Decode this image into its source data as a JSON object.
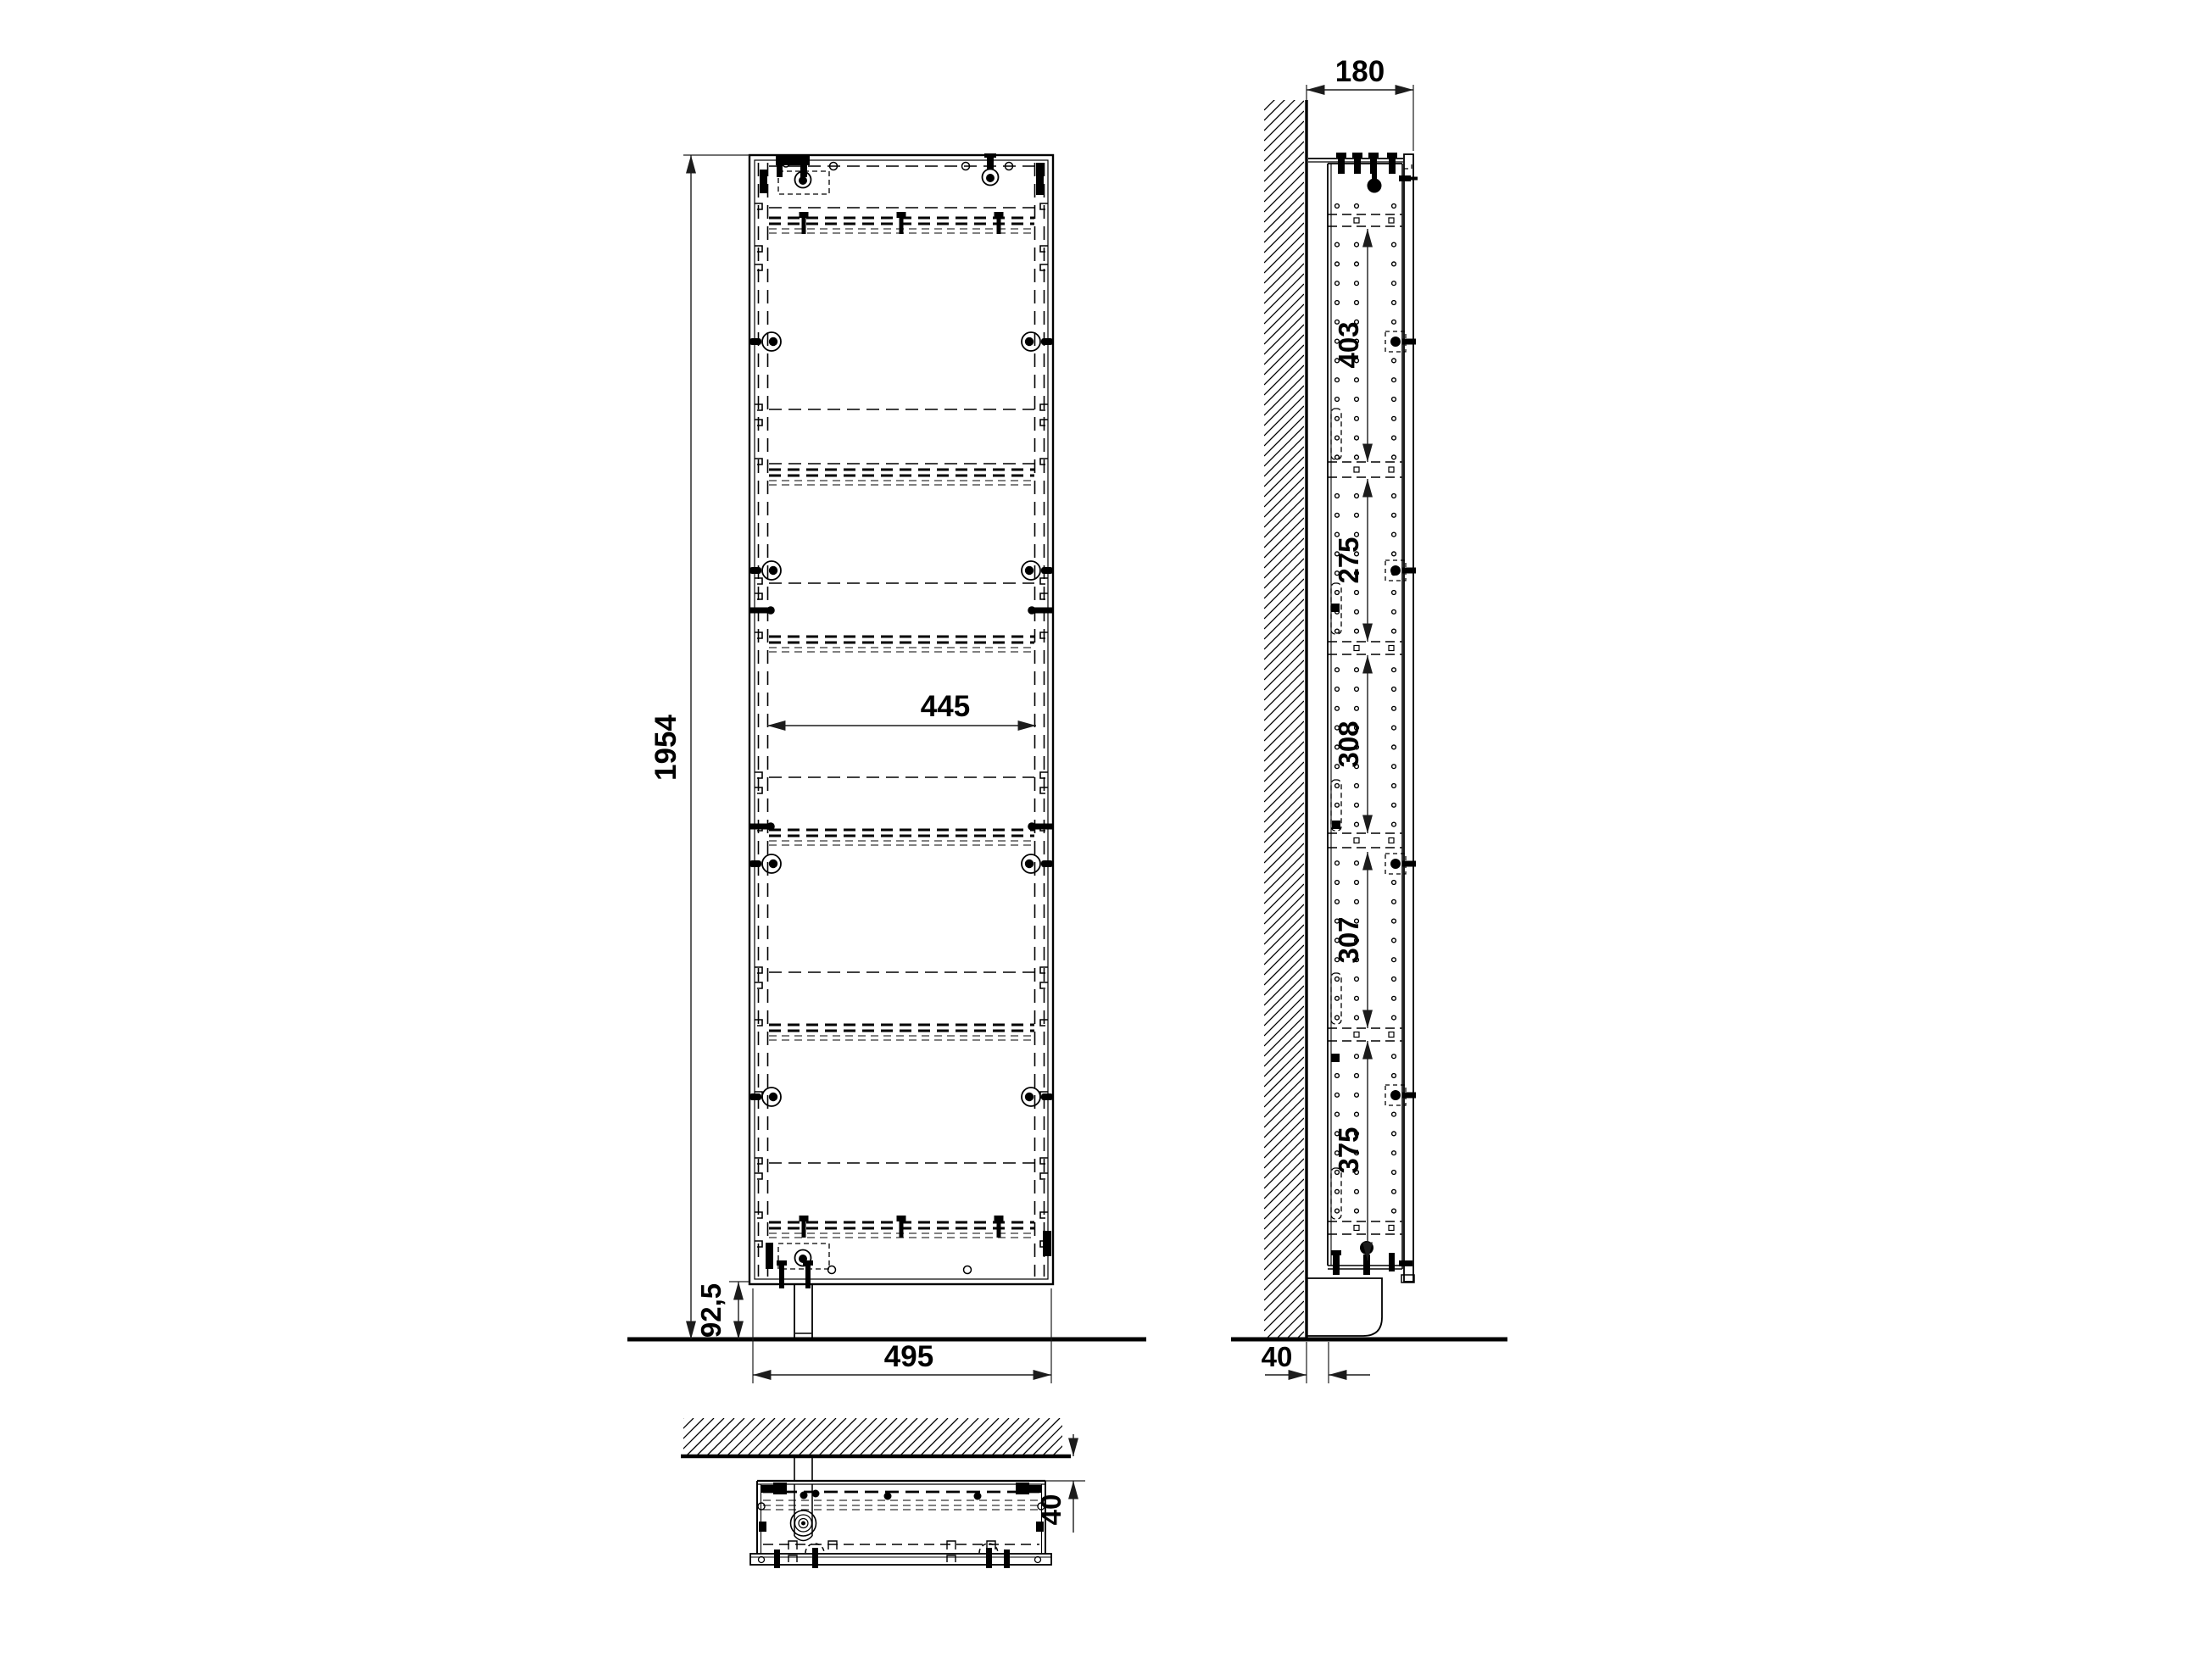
{
  "drawing": {
    "description": "cabinet-installation-drawing",
    "views": {
      "front": "front-view",
      "side": "side-view",
      "bottom": "top-view"
    }
  },
  "dimensions": {
    "front_view": {
      "height": "1954",
      "inner_width": "445",
      "width": "495",
      "plinth_height": "92,5"
    },
    "side_view": {
      "depth": "180",
      "wall_gap": "40",
      "shelf_spacings": [
        "403",
        "275",
        "308",
        "307",
        "375"
      ]
    },
    "top_view": {
      "wall_gap": "40"
    }
  },
  "colors": {
    "line": "#000000",
    "dimension": "#1c1c1c",
    "background": "#ffffff"
  }
}
